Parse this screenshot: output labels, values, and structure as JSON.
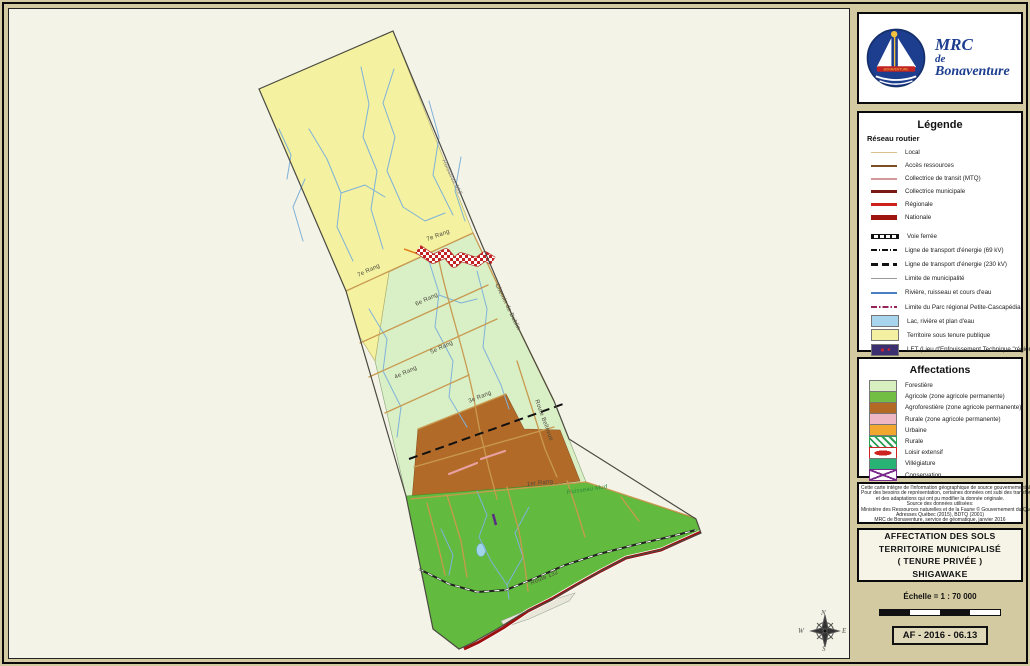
{
  "logo": {
    "line1": "MRC",
    "line2": "de",
    "line3": "Bonaventure",
    "badge_text": "BONAVENTURE"
  },
  "legend": {
    "title": "Légende",
    "road_section_title": "Réseau routier",
    "road_items": [
      {
        "label": "Local",
        "type": "line",
        "color": "#d9c18e",
        "weight": 1.5,
        "icon": "road-local-line"
      },
      {
        "label": "Accès ressources",
        "type": "line",
        "color": "#7b4f1f",
        "weight": 2,
        "icon": "road-resource-line"
      },
      {
        "label": "Collectrice de transit (MTQ)",
        "type": "line",
        "color": "#d49898",
        "weight": 2,
        "icon": "road-collector-mtq-line"
      },
      {
        "label": "Collectrice municipale",
        "type": "line",
        "color": "#7a1a14",
        "weight": 3,
        "icon": "road-collector-municipal-line"
      },
      {
        "label": "Régionale",
        "type": "line",
        "color": "#cc2218",
        "weight": 3.5,
        "icon": "road-regional-line"
      },
      {
        "label": "Nationale",
        "type": "line",
        "color": "#a01410",
        "weight": 4.5,
        "icon": "road-national-line"
      }
    ],
    "other_items": [
      {
        "label": "Voie ferrée",
        "type": "rail",
        "icon": "railway-line"
      },
      {
        "label": "Ligne de transport d'énergie (69 kV)",
        "type": "dashdot",
        "icon": "powerline-69kv"
      },
      {
        "label": "Ligne de transport d'énergie (230 kV)",
        "type": "heavydash",
        "icon": "powerline-230kv"
      },
      {
        "label": "Limite de municipalité",
        "type": "line",
        "color": "#9a9a9a",
        "weight": 1.5,
        "icon": "municipal-limit-line"
      },
      {
        "label": "Rivière, ruisseau et cours d'eau",
        "type": "line",
        "color": "#4a7fc4",
        "weight": 1.5,
        "icon": "river-line"
      },
      {
        "label": "Limite du Parc régional Petite-Cascapédia",
        "type": "parkdash",
        "icon": "regional-park-limit-line"
      },
      {
        "label": "Lac, rivière et plan d'eau",
        "type": "fill",
        "color": "#a8d4ee",
        "icon": "water-fill"
      },
      {
        "label": "Territoire sous tenure publique",
        "type": "fill",
        "color": "#f4f0a2",
        "icon": "public-tenure-fill"
      },
      {
        "label": "LET (Lieu d'Enfouissement Technique \"régional\")",
        "type": "let",
        "icon": "let-fill"
      }
    ]
  },
  "affectations": {
    "title": "Affectations",
    "items": [
      {
        "label": "Forestière",
        "type": "fill",
        "color": "#d8efc0",
        "icon": "forestiere-fill"
      },
      {
        "label": "Agricole (zone agricole permanente)",
        "type": "fill",
        "color": "#72bd44",
        "icon": "agricole-fill"
      },
      {
        "label": "Agroforestière (zone agricole permanente)",
        "type": "fill",
        "color": "#b26a24",
        "icon": "agroforestiere-fill"
      },
      {
        "label": "Rurale (zone agricole permanente)",
        "type": "fill",
        "color": "#efb6c4",
        "icon": "rurale-permanente-fill"
      },
      {
        "label": "Urbaine",
        "type": "fill",
        "color": "#f2a72e",
        "icon": "urbaine-fill"
      },
      {
        "label": "Rurale",
        "type": "hatch",
        "icon": "rurale-hatch"
      },
      {
        "label": "Loisir extensif",
        "type": "blob",
        "icon": "loisir-extensif-pattern"
      },
      {
        "label": "Villégiature",
        "type": "fill",
        "color": "#28b273",
        "icon": "villegiature-fill"
      },
      {
        "label": "Conservation",
        "type": "x",
        "icon": "conservation-pattern"
      }
    ]
  },
  "source_note": {
    "lines": [
      "Cette carte intègre de l'information géographique de source gouvernementale.",
      "Pour des besoins de représentation, certaines données ont subi des transformations",
      "et des adaptations qui ont pu modifier la donnée originale.",
      "Source des données utilisées:",
      "Ministère des Ressources naturelles et de la Faune © Gouvernement du Québec,",
      "Adresses Québec (2015), BDTQ (2001)",
      "MRC de Bonaventure, service de géomatique, janvier 2016"
    ]
  },
  "title_block": {
    "line1": "AFFECTATION DES SOLS",
    "line2": "TERRITOIRE MUNICIPALISÉ",
    "line3": "( TENURE PRIVÉE )",
    "line4": "SHIGAWAKE"
  },
  "scale_block": {
    "scale_text": "Échelle = 1 : 70 000",
    "ref_code": "AF - 2016 - 06.13"
  },
  "colors": {
    "page_bg": "#d3caa1",
    "panel_bg": "#f4f3e7",
    "zone_public": "#f4f1a0",
    "zone_forestiere": "#d9efc6",
    "zone_agroforestiere": "#b26a28",
    "zone_agricole": "#62ba3e",
    "route132": "#9e1010",
    "stream": "#7fb2d9",
    "road": "#c89a50"
  },
  "map": {
    "labels": [
      {
        "text": "7e Rang",
        "x": 349,
        "y": 264,
        "rot": -25,
        "cls": "road"
      },
      {
        "text": "7e Rang",
        "x": 418,
        "y": 228,
        "rot": -20,
        "cls": "road"
      },
      {
        "text": "6e Rang",
        "x": 407,
        "y": 293,
        "rot": -25,
        "cls": "road"
      },
      {
        "text": "5e Rang",
        "x": 422,
        "y": 341,
        "rot": -25,
        "cls": "road"
      },
      {
        "text": "4e Rang",
        "x": 386,
        "y": 366,
        "rot": -25,
        "cls": "road"
      },
      {
        "text": "3e Rang",
        "x": 460,
        "y": 390,
        "rot": -22,
        "cls": "road"
      },
      {
        "text": "1er Rang",
        "x": 518,
        "y": 473,
        "rot": -7,
        "cls": "road"
      },
      {
        "text": "Route Bellevue",
        "x": 527,
        "y": 388,
        "rot": 70,
        "cls": "road"
      },
      {
        "text": "Chemin de Dublin",
        "x": 487,
        "y": 272,
        "rot": 64,
        "cls": "road"
      },
      {
        "text": "Route 132",
        "x": 522,
        "y": 572,
        "rot": -23,
        "cls": "road"
      },
      {
        "text": "Ruisseau Mud",
        "x": 558,
        "y": 481,
        "rot": -8,
        "cls": "stream-green"
      },
      {
        "text": "Ruisseau Mill",
        "x": 434,
        "y": 148,
        "rot": 64,
        "cls": "stream-gray"
      },
      {
        "text": "N",
        "x": 812,
        "y": 600,
        "rot": 0,
        "cls": "compass"
      },
      {
        "text": "E",
        "x": 833,
        "y": 618,
        "rot": 0,
        "cls": "compass"
      },
      {
        "text": "S",
        "x": 813,
        "y": 636,
        "rot": 0,
        "cls": "compass"
      },
      {
        "text": "W",
        "x": 789,
        "y": 618,
        "rot": 0,
        "cls": "compass"
      }
    ]
  }
}
